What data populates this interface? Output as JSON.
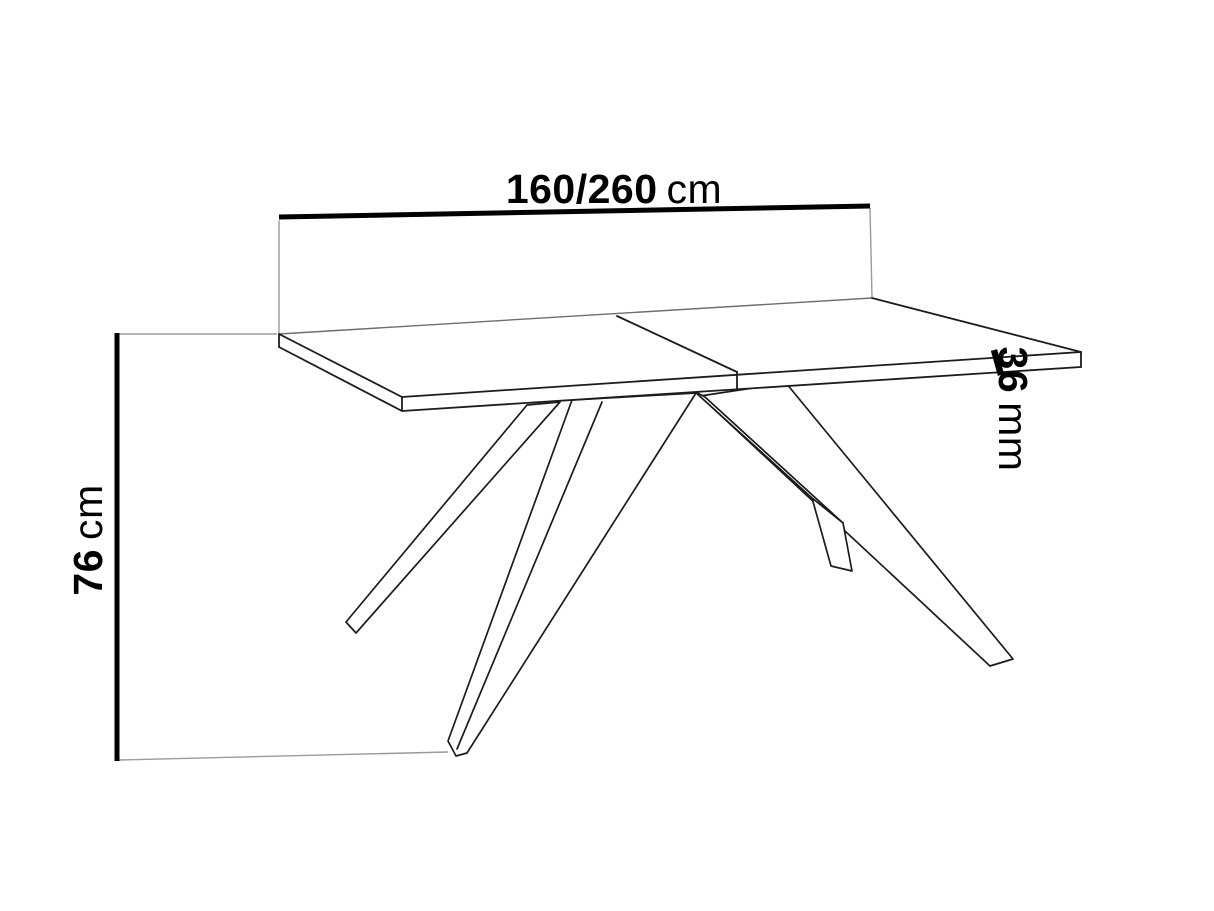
{
  "diagram": {
    "dimensions": {
      "width": {
        "value": "160/260",
        "unit": "cm"
      },
      "height": {
        "value": "76",
        "unit": "cm"
      },
      "thickness": {
        "value": "36",
        "unit": "mm"
      }
    },
    "colors": {
      "background": "#ffffff",
      "outline": "#1c1c1c",
      "dimension_line": "#000000",
      "extension_line": "#9a9a9a",
      "back_edge": "#6e6e6e"
    }
  }
}
